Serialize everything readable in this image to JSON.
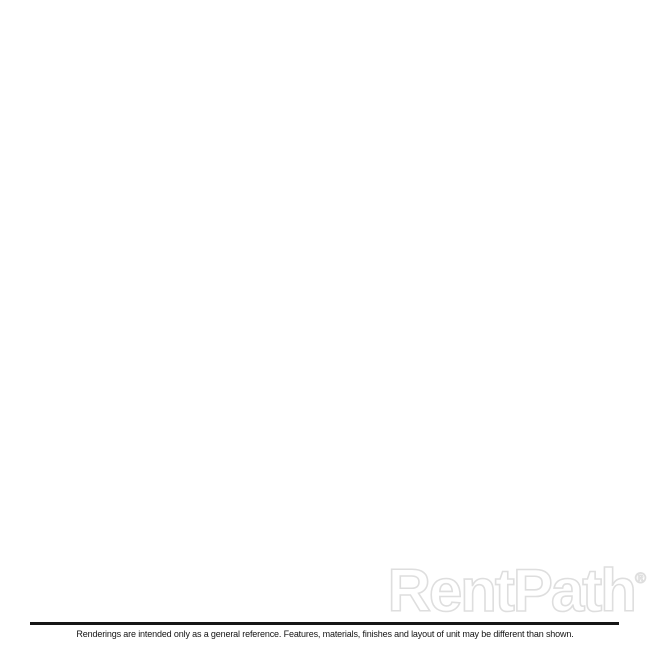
{
  "branding": {
    "watermark": "RentPath",
    "registered": "®"
  },
  "footer": {
    "disclaimer": "Renderings are intended only as a general reference. Features, materials, finishes and layout of unit may be different than shown."
  },
  "floorplan": {
    "corners": {
      "nw": [
        281,
        50
      ],
      "ne": [
        612,
        262
      ],
      "se": [
        379,
        539
      ],
      "sw": [
        43,
        277
      ]
    },
    "plan_size": 430,
    "wall_height_px": 55,
    "colors": {
      "wallTop": "#3a3a3c",
      "wallStroke": "#29292b",
      "bedroomFloor": "#e9d7a1",
      "stripFloor": "#e6d49e",
      "hallFloor": "#e3d099",
      "bathFloor": "#e7d5a0",
      "faceNorth": "#f3e8bc",
      "faceWest": "#eee0ab",
      "faceEW": "#f0e4b4",
      "faceNS": "#e8d8a2",
      "glass": "#ffffff",
      "glassStroke": "#e6e6e2",
      "sill": "#f6f6f2",
      "jamb": "#fafaf7",
      "mirror": "#fcfcfa",
      "panel": "#fdfdfd",
      "panelStroke": "#d8d8d4",
      "counterTop": "#c89055",
      "counterSide": "#9c6c3c",
      "islandTop": "#f3efe4",
      "islandSide": "#b5854f",
      "fixtureTop": "#f6f6f3",
      "fixtureSide": "#e2e2dc",
      "bowl": "#e3e7e6",
      "bowlStroke": "#c9cdcc",
      "extBack": "#f2f2f2",
      "threshold": "#c9a871",
      "arrow": "#252525",
      "woodGap": "#9c6c3c",
      "plank1": "#c2915c",
      "plank2": "#aa7a46",
      "plank3": "#b4854f",
      "plank4": "#c79a63",
      "plank5": "#a87946",
      "tileBase": "#f0eee6",
      "grout": "#d8d4c7"
    },
    "floors": [
      {
        "n": "floor-bedroom",
        "r": [
          12,
          12,
          230,
          160
        ],
        "f": "bedroomFloor"
      },
      {
        "n": "floor-bedroom-closet-strip",
        "r": [
          12,
          12,
          45,
          262
        ],
        "f": "stripFloor"
      },
      {
        "n": "floor-hallway-entry",
        "r": [
          45,
          160,
          230,
          418
        ],
        "f": "hallFloor"
      },
      {
        "n": "floor-bathroom",
        "r": [
          12,
          250,
          137,
          418
        ],
        "f": "bathFloor"
      },
      {
        "n": "floor-living-room-wood",
        "r": [
          230,
          12,
          418,
          312
        ],
        "f": "wood"
      },
      {
        "n": "floor-entry-wood-strip",
        "r": [
          230,
          310,
          242,
          418
        ],
        "f": "wood"
      },
      {
        "n": "floor-kitchen-tile",
        "r": [
          242,
          312,
          418,
          418
        ],
        "f": "tile"
      }
    ],
    "facesEW": [
      {
        "n": "face-north-wall",
        "u1": 12,
        "u2": 418,
        "v": 12,
        "f": "faceNorth"
      },
      {
        "n": "face-bathroom-north-wall",
        "u1": 12,
        "u2": 137,
        "v": 262,
        "f": "faceEW"
      },
      {
        "n": "face-bedroom-south-wall-west",
        "u1": 45,
        "u2": 60,
        "v": 172,
        "f": "faceEW"
      },
      {
        "n": "face-bedroom-south-wall-east",
        "u1": 100,
        "u2": 230,
        "v": 172,
        "f": "faceEW"
      },
      {
        "n": "face-closet-north-wall",
        "u1": 85,
        "u2": 158,
        "v": 345,
        "f": "faceEW"
      },
      {
        "n": "face-closet-south-wall",
        "u1": 85,
        "u2": 158,
        "v": 408,
        "f": "faceEW"
      },
      {
        "n": "face-kitchen-divider-wall",
        "u1": 280,
        "u2": 418,
        "v": 312,
        "f": "faceEW"
      }
    ],
    "facesNS": [
      {
        "n": "face-west-wall",
        "u": 12,
        "v1": 12,
        "v2": 418,
        "f": "faceWest"
      },
      {
        "n": "face-closet-strip-wall",
        "u": 57,
        "v1": 12,
        "v2": 250,
        "f": "faceNS"
      },
      {
        "n": "face-living-divider-north",
        "u": 242,
        "v1": 12,
        "v2": 210,
        "f": "faceNS"
      },
      {
        "n": "face-living-divider-south",
        "u": 242,
        "v1": 270,
        "v2": 310,
        "f": "faceNS"
      },
      {
        "n": "face-bathroom-east-wall-north",
        "u": 137,
        "v1": 262,
        "v2": 290,
        "f": "faceNS"
      },
      {
        "n": "face-bathroom-east-wall-south",
        "u": 137,
        "v1": 350,
        "v2": 418,
        "f": "faceNS"
      },
      {
        "n": "face-closet-west-wall",
        "u": 95,
        "v1": 345,
        "v2": 398,
        "f": "faceNS"
      },
      {
        "n": "face-closet-east-wall-north",
        "u": 158,
        "v1": 345,
        "v2": 362,
        "f": "faceNS"
      },
      {
        "n": "face-closet-east-wall-south",
        "u": 158,
        "v1": 385,
        "v2": 398,
        "f": "faceNS"
      }
    ],
    "jambsEW": [
      {
        "n": "jamb-bedroom-door-west",
        "u1": 60,
        "u2": 64,
        "v": 172
      },
      {
        "n": "jamb-bedroom-door-east",
        "u1": 96,
        "u2": 100,
        "v": 172
      }
    ],
    "jambsNS": [
      {
        "n": "jamb-living-door-north",
        "u": 242,
        "v1": 210,
        "v2": 215
      },
      {
        "n": "jamb-living-door-south",
        "u": 242,
        "v1": 265,
        "v2": 270
      },
      {
        "n": "jamb-bathroom-door-north",
        "u": 137,
        "v1": 290,
        "v2": 295
      },
      {
        "n": "jamb-bathroom-door-south",
        "u": 137,
        "v1": 345,
        "v2": 350
      }
    ],
    "windows": [
      {
        "n": "window-bedroom",
        "u1": 25,
        "u2": 208,
        "mullion": 116
      },
      {
        "n": "window-living-room",
        "u1": 256,
        "u2": 406,
        "mullion": 331
      }
    ],
    "window_glass_top": 10,
    "window_glass_bottom": 46,
    "window_sill_bottom": 54,
    "mirror": {
      "n": "bathroom-mirror",
      "u": 12,
      "v1": 282,
      "v2": 324,
      "t1": 8,
      "t2": 38
    },
    "boxes": [
      {
        "n": "kitchen-counter-north",
        "r": [
          300,
          312,
          418,
          340
        ],
        "hh": 20,
        "top": "counterTop",
        "side": "counterSide"
      },
      {
        "n": "kitchen-counter-east",
        "r": [
          390,
          340,
          418,
          418
        ],
        "hh": 20,
        "top": "counterTop",
        "side": "counterSide"
      },
      {
        "n": "kitchen-island",
        "r": [
          285,
          332,
          372,
          366
        ],
        "hh": 22,
        "top": "islandTop",
        "side": "islandSide"
      },
      {
        "n": "bathroom-vanity",
        "r": [
          12,
          275,
          48,
          330
        ],
        "hh": 16,
        "top": "fixtureTop",
        "side": "fixtureSide"
      },
      {
        "n": "toilet-tank",
        "r": [
          13,
          345,
          40,
          366
        ],
        "hh": 14,
        "top": "fixtureTop",
        "side": "fixtureSide"
      }
    ],
    "ellipses": [
      {
        "n": "vanity-sink-bowl",
        "c": [
          30,
          302
        ],
        "rx": 10,
        "ry": 6.5,
        "rot": 17,
        "f": "bowl",
        "s": "bowlStroke"
      },
      {
        "n": "toilet-bowl",
        "c": [
          50,
          356
        ],
        "rx": 12,
        "ry": 8,
        "rot": 17,
        "f": "fixtureTop",
        "s": "bowlStroke"
      }
    ],
    "panelsNS": [
      {
        "n": "bedroom-door-open",
        "u": 62,
        "v1": 172,
        "v2": 216
      },
      {
        "n": "closet-door-open",
        "u": 165,
        "v1": 343,
        "v2": 388
      }
    ],
    "panelsEW": [
      {
        "n": "bathroom-door-open",
        "u1": 95,
        "u2": 127,
        "v": 264
      }
    ],
    "tops_interior": [
      {
        "n": "wall-closet-strip",
        "r": [
          45,
          12,
          57,
          250
        ]
      },
      {
        "n": "wall-bathroom-north",
        "r": [
          12,
          250,
          137,
          262
        ]
      },
      {
        "n": "wall-bedroom-south-west",
        "r": [
          45,
          160,
          60,
          172
        ]
      },
      {
        "n": "wall-bedroom-south-east",
        "r": [
          100,
          160,
          242,
          172
        ]
      },
      {
        "n": "wall-living-divider-north",
        "r": [
          230,
          12,
          242,
          210
        ]
      },
      {
        "n": "wall-living-divider-south",
        "r": [
          230,
          270,
          242,
          310
        ]
      },
      {
        "n": "wall-bathroom-east-north",
        "r": [
          125,
          262,
          137,
          290
        ]
      },
      {
        "n": "wall-bathroom-east-south",
        "r": [
          125,
          350,
          137,
          418
        ]
      },
      {
        "n": "wall-closet-north",
        "r": [
          85,
          335,
          158,
          345
        ]
      },
      {
        "n": "wall-closet-west",
        "r": [
          85,
          345,
          95,
          398
        ]
      },
      {
        "n": "wall-closet-south",
        "r": [
          85,
          398,
          158,
          408
        ]
      },
      {
        "n": "wall-closet-east-north",
        "r": [
          148,
          345,
          158,
          362
        ]
      },
      {
        "n": "wall-closet-east-south",
        "r": [
          148,
          385,
          158,
          398
        ]
      },
      {
        "n": "wall-kitchen-divider",
        "r": [
          280,
          300,
          418,
          312
        ]
      }
    ],
    "tops_perimeter": [
      {
        "n": "wall-north",
        "r": [
          0,
          0,
          430,
          12
        ]
      },
      {
        "n": "wall-west",
        "r": [
          0,
          0,
          12,
          430
        ]
      },
      {
        "n": "wall-south",
        "r": [
          0,
          418,
          430,
          430
        ]
      },
      {
        "n": "wall-east",
        "r": [
          418,
          0,
          430,
          430
        ]
      }
    ],
    "exterior_back": [
      {
        "n": "exterior-west-face",
        "pts": [
          [
            281,
            50
          ],
          [
            43,
            277
          ],
          [
            30,
            339
          ],
          [
            278,
            58
          ]
        ],
        "f": "extBack"
      }
    ],
    "exterior_front": [
      {
        "n": "exterior-south-face",
        "pts": [
          [
            43,
            277
          ],
          [
            379,
            539
          ],
          [
            384,
            586
          ],
          [
            30,
            339
          ]
        ],
        "f": "gradS"
      },
      {
        "n": "exterior-east-face",
        "pts": [
          [
            612,
            262
          ],
          [
            379,
            539
          ],
          [
            384,
            586
          ],
          [
            634,
            304
          ]
        ],
        "f": "gradE"
      }
    ],
    "entry_door": {
      "n": "entry-door",
      "pts": [
        [
          163,
          371
        ],
        [
          201,
          400
        ],
        [
          203,
          444
        ],
        [
          161,
          415
        ]
      ],
      "inner": [
        [
          168,
          381
        ],
        [
          196,
          403
        ],
        [
          197,
          436
        ],
        [
          167,
          413
        ]
      ]
    },
    "threshold": {
      "n": "entry-threshold",
      "pts": [
        [
          165,
          415
        ],
        [
          199,
          442
        ],
        [
          199,
          452
        ],
        [
          165,
          425
        ]
      ]
    },
    "arrow": {
      "n": "entry-arrow",
      "pts": [
        [
          193,
          433
        ],
        [
          188,
          451
        ],
        [
          183,
          446
        ],
        [
          173,
          456
        ],
        [
          168,
          451
        ],
        [
          179,
          441
        ],
        [
          174,
          436
        ]
      ]
    }
  }
}
